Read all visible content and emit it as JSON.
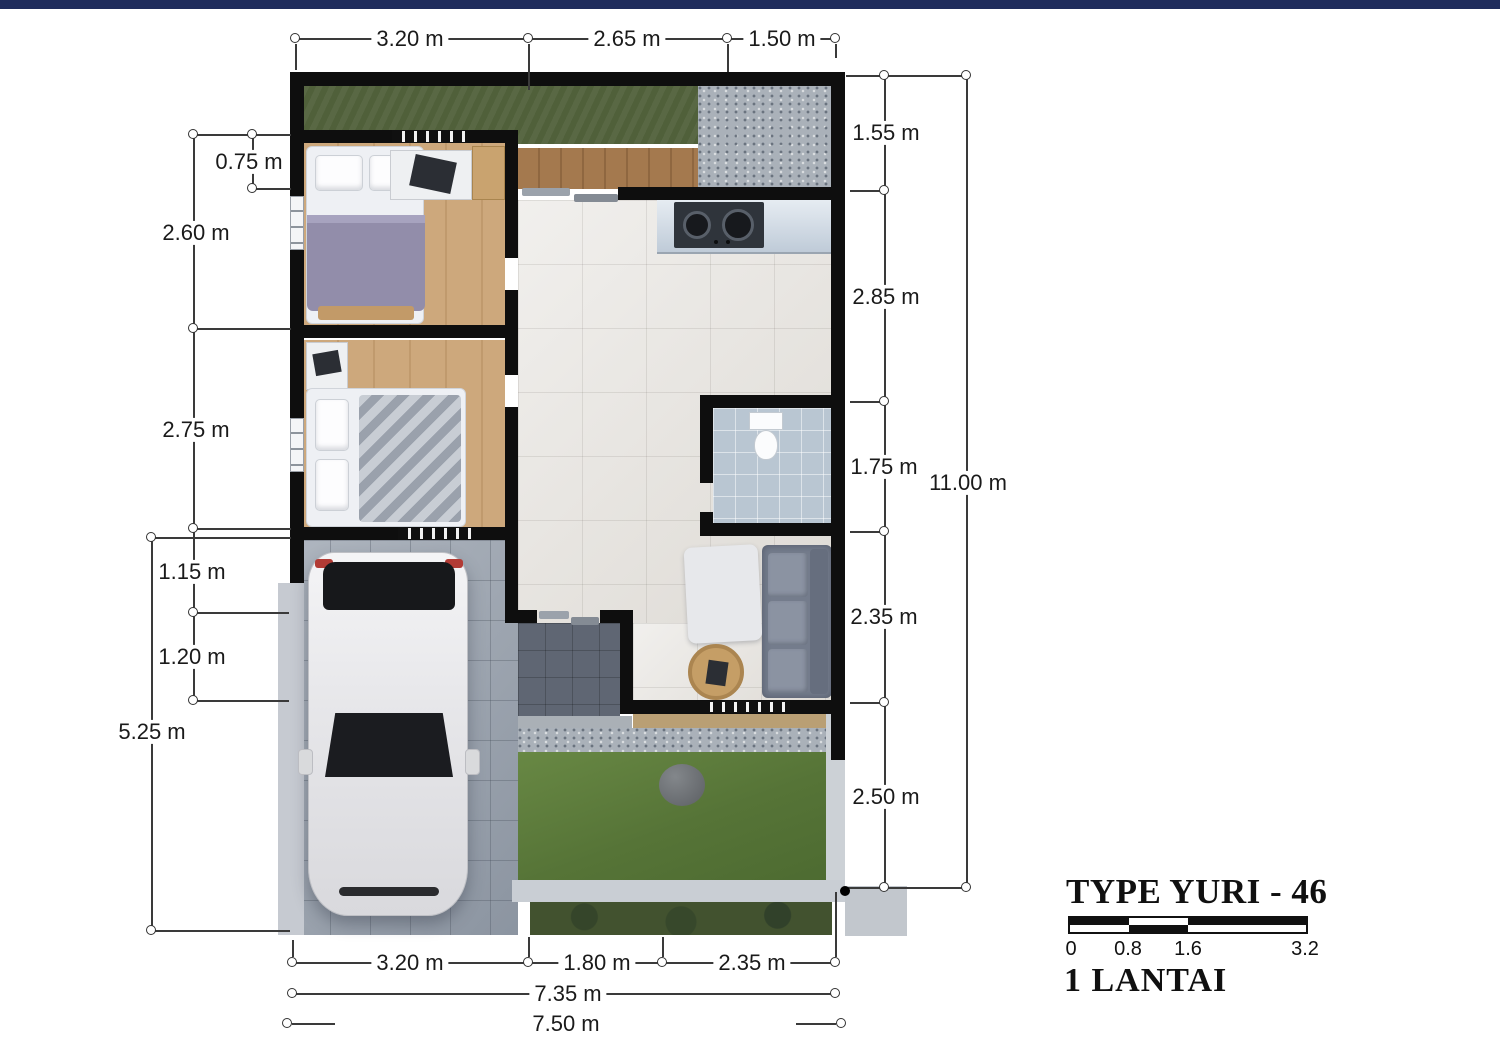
{
  "colors": {
    "top_bar": "#1f2c5c",
    "wall": "#0e0e0e",
    "dim_line": "#3a3a3a",
    "text": "#1a1a1a",
    "grass": "#50603a",
    "lawn": "#5c7a40"
  },
  "dimensions": {
    "top": [
      "3.20 m",
      "2.65 m",
      "1.50 m"
    ],
    "left": [
      "0.75 m",
      "2.60 m",
      "2.75 m",
      "1.15 m",
      "1.20 m",
      "5.25 m"
    ],
    "right": [
      "1.55 m",
      "2.85 m",
      "1.75 m",
      "2.35 m",
      "2.50 m",
      "11.00 m"
    ],
    "bottom_segments": [
      "3.20 m",
      "1.80 m",
      "2.35 m"
    ],
    "bottom_totals": [
      "7.35 m",
      "7.50 m"
    ]
  },
  "title_block": {
    "title": "TYPE YURI - 46",
    "floor": "1 LANTAI",
    "scale_ticks": [
      "0",
      "0.8",
      "1.6",
      "3.2"
    ]
  }
}
